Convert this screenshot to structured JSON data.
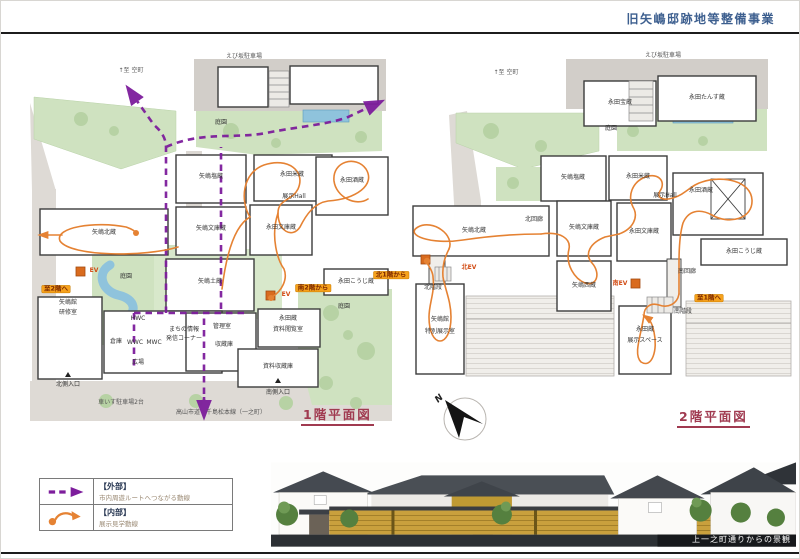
{
  "header": {
    "title": "旧矢嶋邸跡地等整備事業"
  },
  "compass": {
    "north": "N"
  },
  "plan1": {
    "title": "1階平面図",
    "labels": {
      "dir_north": "↑至 空町",
      "parking": "えび坂駐車場",
      "garden_top": "庭園",
      "garden_pond": "庭園",
      "garden_right": "庭園",
      "yajima_kita": "矢嶋北蔵",
      "yajima_shio": "矢嶋塩蔵",
      "yajima_bunko": "矢嶋文庫蔵",
      "yajima_do": "矢嶋土蔵",
      "yajima_kan": "矢嶋館",
      "kenshu": "研修室",
      "nagata_kome": "永田米蔵",
      "nagata_bunko": "永田文庫蔵",
      "tenji_hall": "展示Hall",
      "nagata_saka": "永田酒蔵",
      "nagata_koji": "永田こうじ蔵",
      "kanri": "管理室",
      "shuzo": "収蔵庫",
      "soko": "倉庫",
      "hwc": "HWC",
      "wwc": "WWC",
      "mwc": "MWC",
      "info1": "まちの情報",
      "info2": "発信コーナー",
      "hiroba": "広場",
      "nagata_kura": "永田蔵",
      "shiryo_etsuran": "資料閲覧室",
      "shiryo_shuzo": "資料収蔵庫",
      "south_entrance": "南側入口",
      "north_entrance": "北側入口",
      "wheelchair": "車いす駐車場2台",
      "road": "高山市道　千島松本線（一之町）",
      "to_2f": "至2階へ",
      "from_2f_south": "南2階から",
      "ev": "EV"
    }
  },
  "plan2": {
    "title": "2階平面図",
    "labels": {
      "dir_north": "↑至 空町",
      "parking": "えび坂駐車場",
      "garden": "庭園",
      "nagata_takara": "永田宝蔵",
      "nagata_tansu": "永田たんす蔵",
      "yajima_shio": "矢嶋塩蔵",
      "yajima_kita": "矢嶋北蔵",
      "kita_kairo": "北回廊",
      "yajima_bunko": "矢嶋文庫蔵",
      "nagata_bunko": "永田文庫蔵",
      "yajima_nishi": "矢嶋西蔵",
      "nagata_kome": "永田米蔵",
      "tenji_hall": "展示Hall",
      "nagata_saka": "永田酒蔵",
      "nagata_koji": "永田こうじ蔵",
      "minami_kairo": "南回廊",
      "minami_ev": "南EV",
      "minami_kaidan": "南階段",
      "kita_ev": "北EV",
      "kita_kaidan": "北階段",
      "to_1f": "至1階へ",
      "from_1f_north": "北1階から",
      "nagata_kura": "永田蔵",
      "tenji_space": "展示スペース",
      "yajima_kan": "矢嶋館",
      "tokubetsu": "特別展示室"
    }
  },
  "legend": {
    "rows": [
      {
        "category": "【外部】",
        "desc": "市内周遊ルートへつながる動線"
      },
      {
        "category": "【内部】",
        "desc": "展示見学動線"
      }
    ]
  },
  "perspective": {
    "caption": "上一之町通りからの景観"
  },
  "colors": {
    "route_external": "#7d1d9c",
    "route_internal": "#e58233",
    "highlight": "#f6a21d",
    "title_blue": "#3d5f8f",
    "plan_title_red": "#a03a50"
  }
}
